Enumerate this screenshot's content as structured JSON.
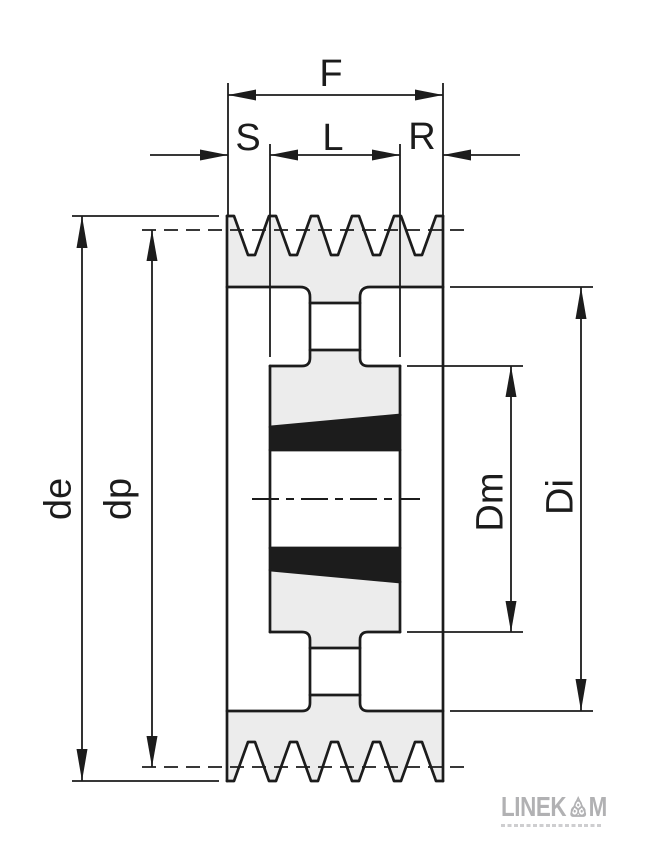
{
  "drawing": {
    "description": "Cross-section of a multi-groove V-belt pulley with taper bush",
    "dimension_labels": {
      "F": "F",
      "S": "S",
      "L": "L",
      "R": "R",
      "de": "de",
      "dp": "dp",
      "Dm": "Dm",
      "Di": "Di"
    }
  },
  "logo": {
    "wordmark_prefix": "LINEK",
    "wordmark_suffix": "M",
    "icon": "bearing-rollers-icon",
    "color": "#b1b1b3"
  },
  "colors": {
    "line": "#1c1c1c",
    "section_fill": "#ececec",
    "taper_wedge_fill": "#1c1c1c",
    "background": "#ffffff"
  }
}
